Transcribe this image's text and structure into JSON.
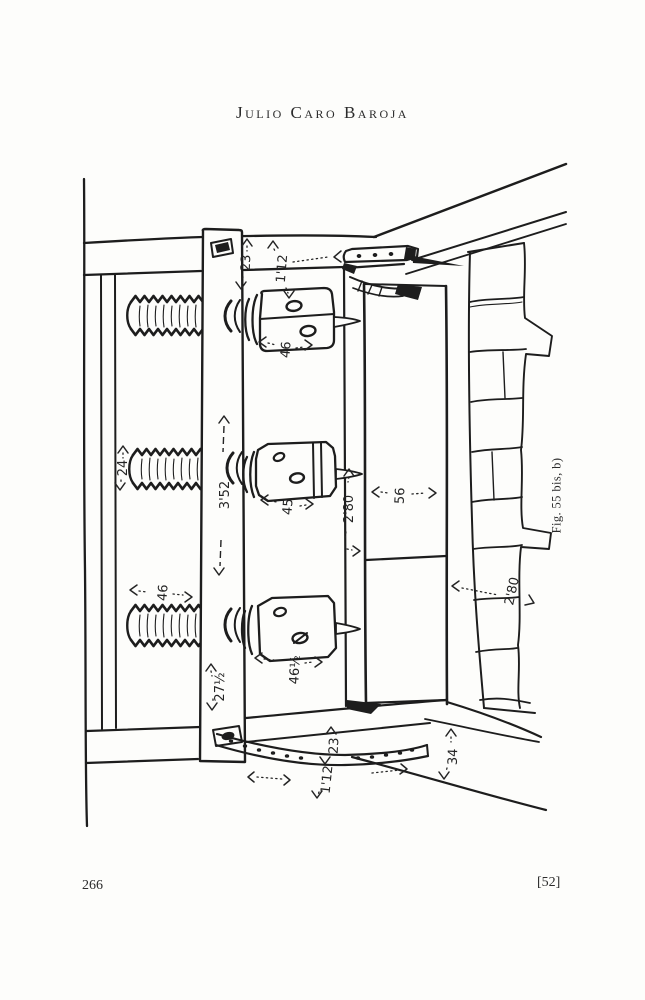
{
  "page": {
    "header": "Julio Caro Baroja",
    "footer_left": "266",
    "footer_right": "[52]"
  },
  "figure": {
    "caption": "Fig. 55 bis, b)",
    "dims": {
      "top23": "23",
      "top112": "1'12",
      "nut_top": "46",
      "screw_mid": "24",
      "beam": "3'52",
      "nut_mid": "45",
      "bed": "2'80",
      "side": "56",
      "screw_bottom": "46",
      "nut_bottom": "46½",
      "beam_end": "27½",
      "bottom23": "23",
      "bottom112": "1'12",
      "base": "34",
      "wall": "2'80"
    }
  },
  "colors": {
    "ink": "#1d1d1d",
    "paper": "#fdfdfb"
  }
}
